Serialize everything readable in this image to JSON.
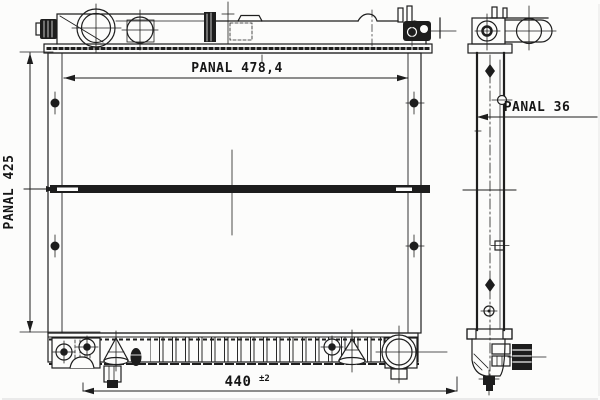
{
  "drawing": {
    "description": "radiator technical drawing, front view and side view",
    "labels": {
      "core_width": "PANAL 478,4",
      "core_height": "PANAL 425",
      "core_depth": "PANAL 36",
      "mount_width": "440",
      "mount_tolerance": "±2"
    },
    "colors": {
      "ink": "#1d1d1d",
      "paper": "#fcfcfb"
    }
  }
}
